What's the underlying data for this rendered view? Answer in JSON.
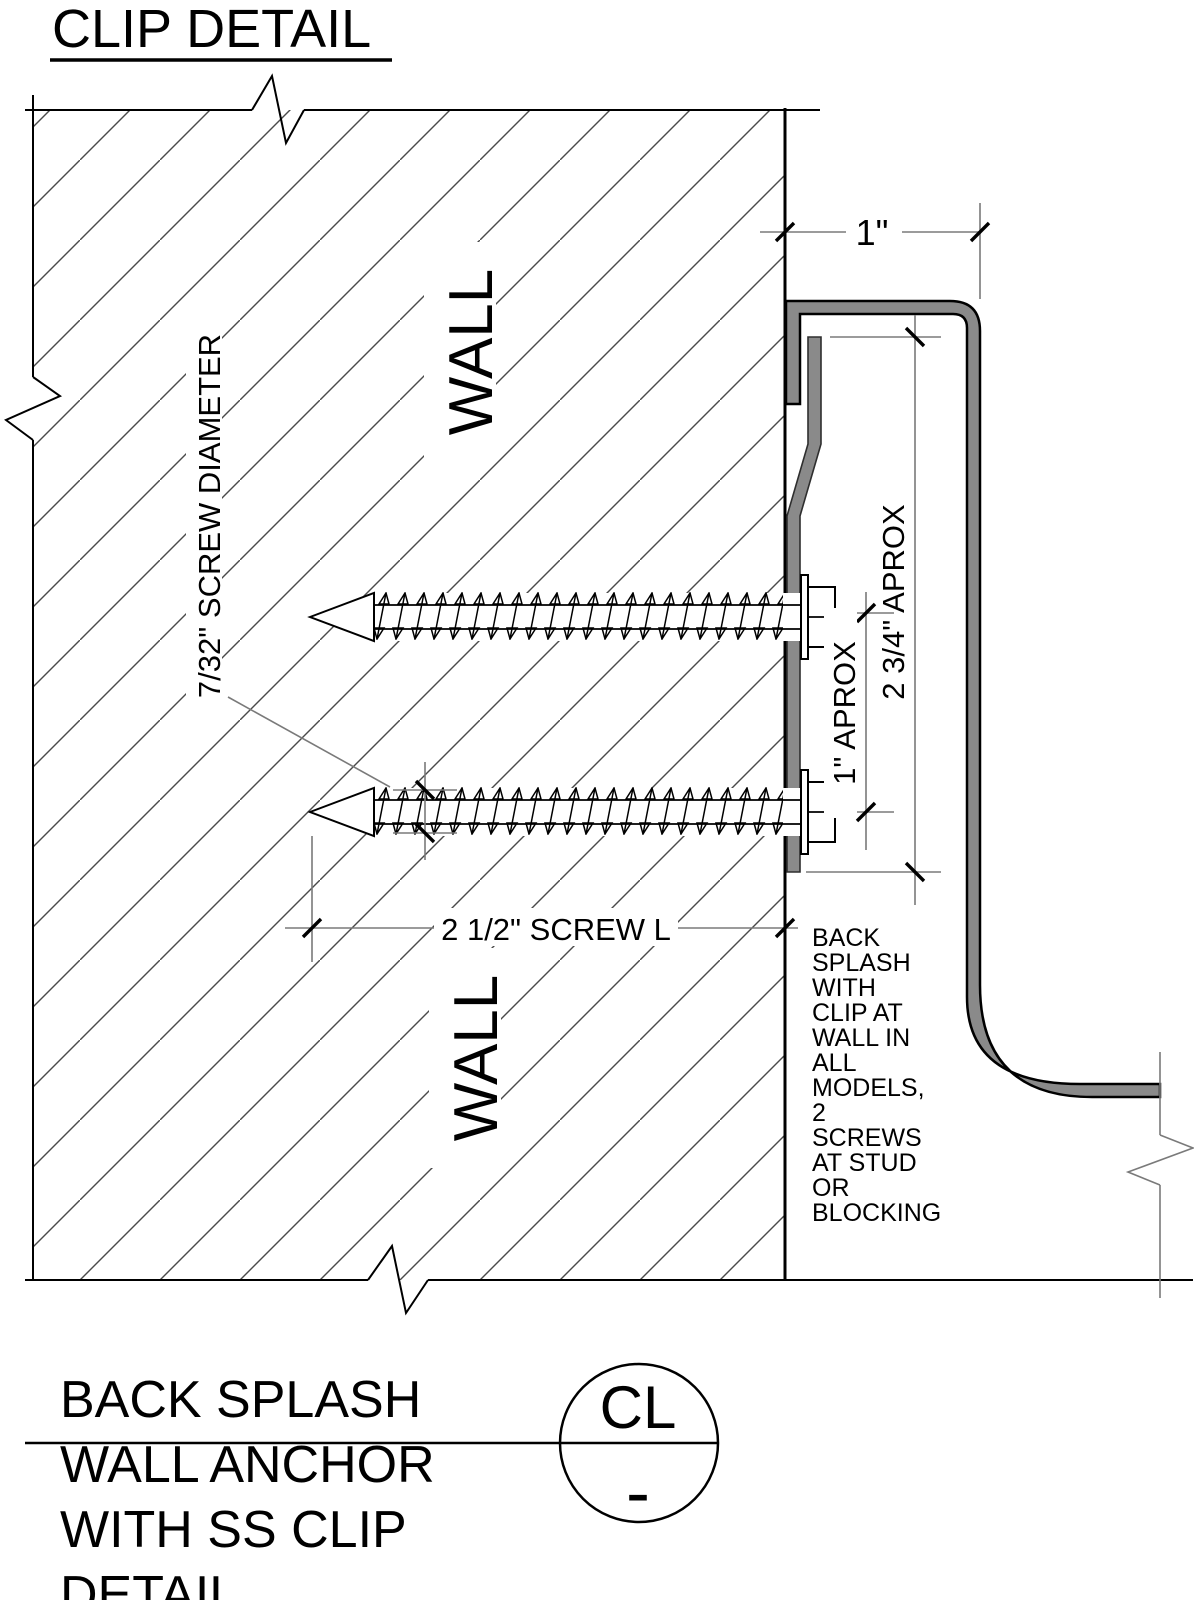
{
  "drawing": {
    "title": "CLIP DETAIL",
    "labels": {
      "wall_upper": "WALL",
      "wall_lower": "WALL"
    },
    "dimensions": {
      "top_offset": "1\"",
      "clip_height": "2 3/4\" APROX",
      "screw_spacing": "1\" APROX",
      "screw_diameter": "7/32\" SCREW DIAMETER",
      "screw_length": "2 1/2\" SCREW L"
    },
    "note_lines": [
      "BACK",
      "SPLASH",
      "WITH",
      "CLIP AT",
      "WALL IN",
      "ALL",
      "MODELS,",
      "2",
      "SCREWS",
      "AT STUD",
      "OR",
      "BLOCKING"
    ],
    "title_block": {
      "line1": "BACK SPLASH",
      "line2": "WALL ANCHOR",
      "line3": "WITH SS CLIP",
      "line4": "DETAIL",
      "detail_tag": "CL",
      "sheet_ref": "-"
    },
    "colors": {
      "steel": "#8a8a8a",
      "outline": "#000000",
      "dim_line": "#7a7a7a",
      "background": "#ffffff"
    }
  }
}
